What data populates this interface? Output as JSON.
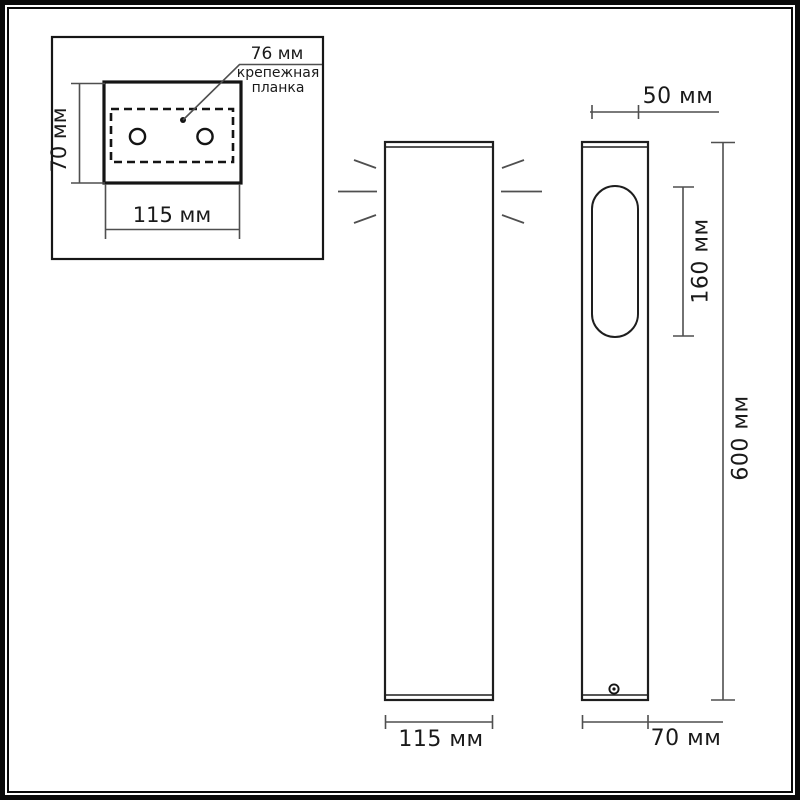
{
  "colors": {
    "background": "#ffffff",
    "frame": "#0a0a0a",
    "object_line": "#1e1e1e",
    "dim_line": "#4f4f4f",
    "text": "#1a1a1a"
  },
  "inset_panel": {
    "callout": {
      "value": "76 мм",
      "label_line1": "крепежная",
      "label_line2": "планка"
    },
    "dim_height": "70 мм",
    "dim_width": "115 мм"
  },
  "front_view": {
    "dim_width": "115 мм"
  },
  "side_view": {
    "dim_window_width": "50 мм",
    "dim_window_height": "160 мм",
    "dim_total_height": "600 мм",
    "dim_depth": "70 мм"
  }
}
